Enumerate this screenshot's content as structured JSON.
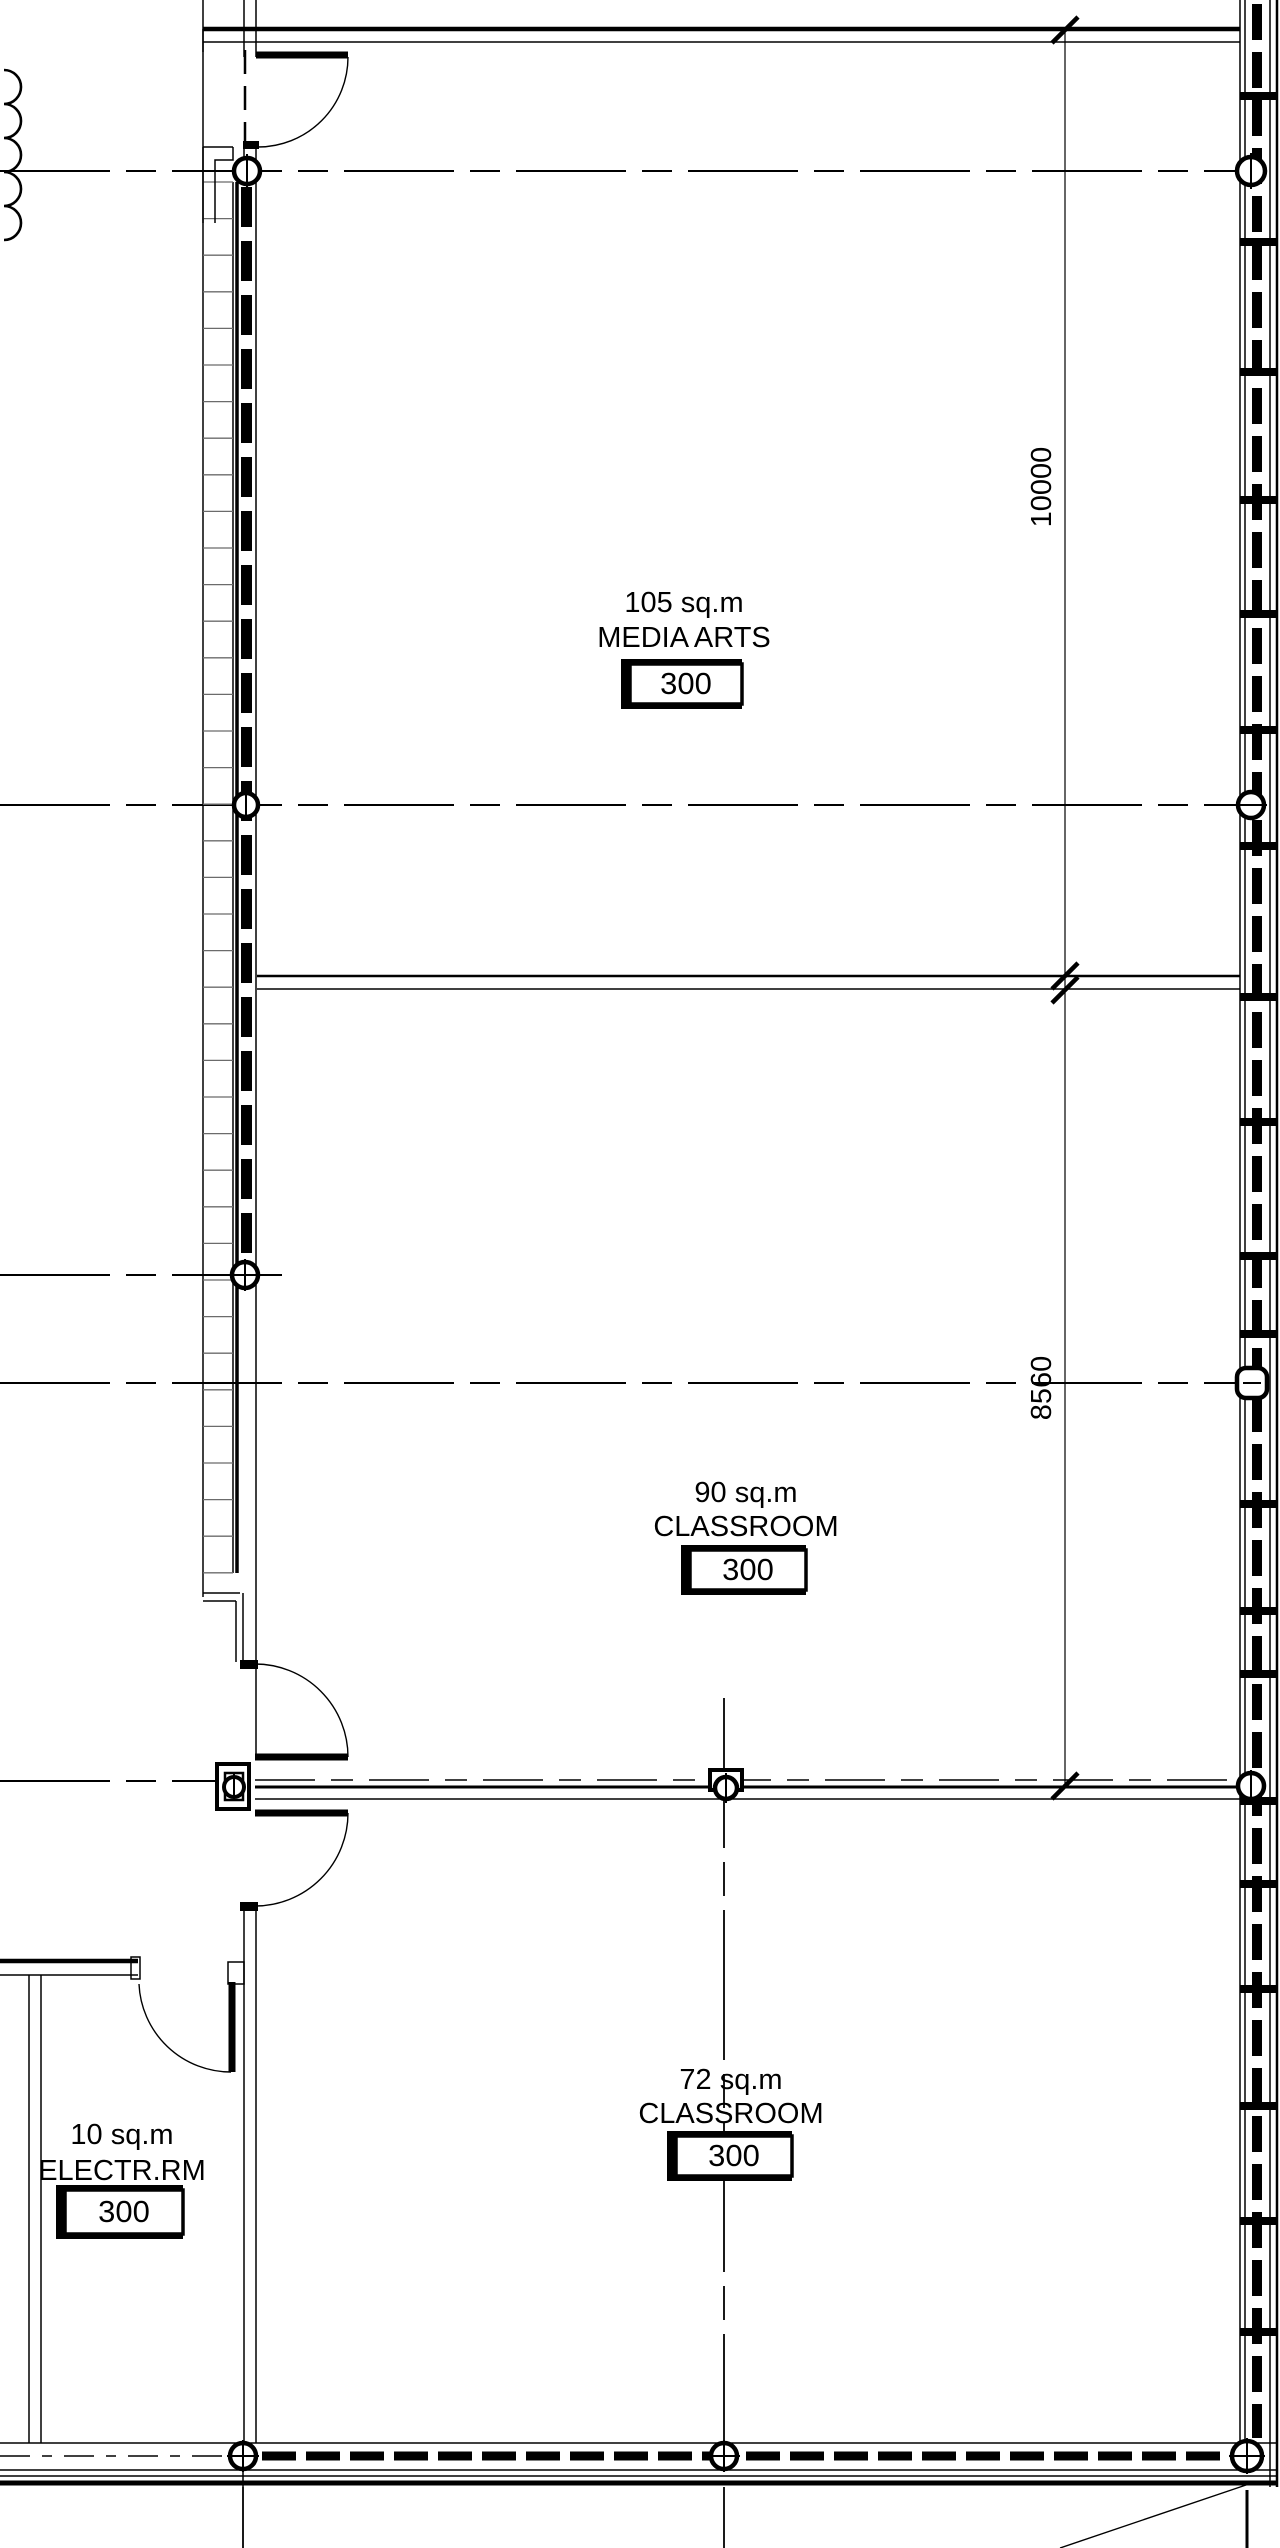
{
  "drawing": {
    "type": "architectural floor plan",
    "colors": {
      "line": "#000000",
      "background": "#ffffff"
    },
    "rooms": [
      {
        "id": "media-arts",
        "area_label": "105 sq.m",
        "name": "MEDIA ARTS",
        "tag": "300"
      },
      {
        "id": "classroom-90",
        "area_label": "90 sq.m",
        "name": "CLASSROOM",
        "tag": "300"
      },
      {
        "id": "classroom-72",
        "area_label": "72 sq.m",
        "name": "CLASSROOM",
        "tag": "300"
      },
      {
        "id": "electrical-room",
        "area_label": "10 sq.m",
        "name": "ELECTR.RM",
        "tag": "300"
      }
    ],
    "dimensions": [
      {
        "id": "dim-media-arts-depth",
        "value": "10000"
      },
      {
        "id": "dim-classroom-depth",
        "value": "8560"
      }
    ]
  }
}
